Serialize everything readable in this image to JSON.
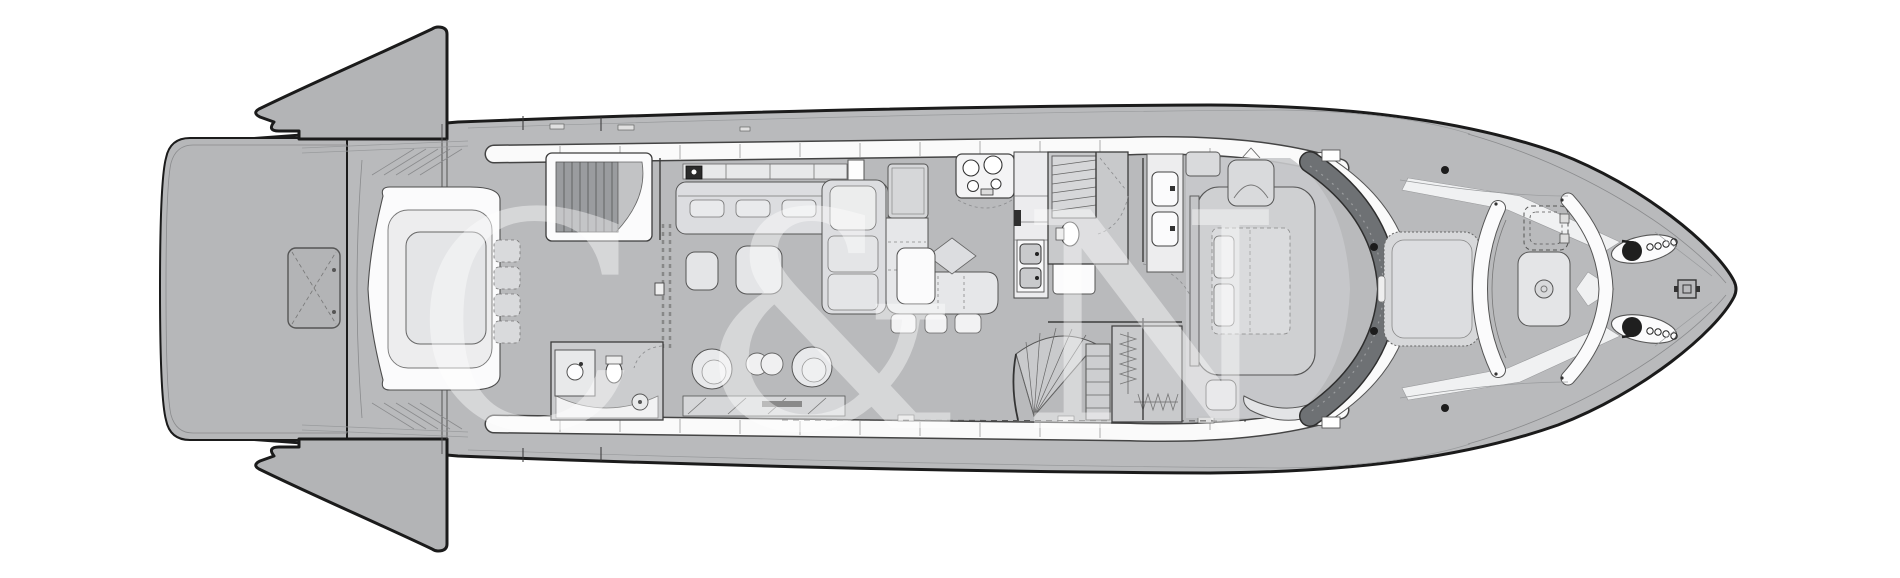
{
  "watermark": {
    "text": "C&N",
    "fill": "rgba(255,255,255,0.42)"
  },
  "colors": {
    "background": "#ffffff",
    "hull": "#b9babc",
    "platform": "#b6b7b9",
    "wing": "#b3b4b6",
    "hatch": "#b3b4b6",
    "outline": "#1b1b1b",
    "windshield": "#6e7174",
    "window_band": "#fafafa",
    "stair_treads": "#9a9c9f",
    "furniture_light": "#e2e3e5",
    "furniture_white": "#fbfbfc",
    "master_floor": "#c8c9cb",
    "sun_pad": "#d7d8da",
    "table": "#e4e5e7"
  }
}
